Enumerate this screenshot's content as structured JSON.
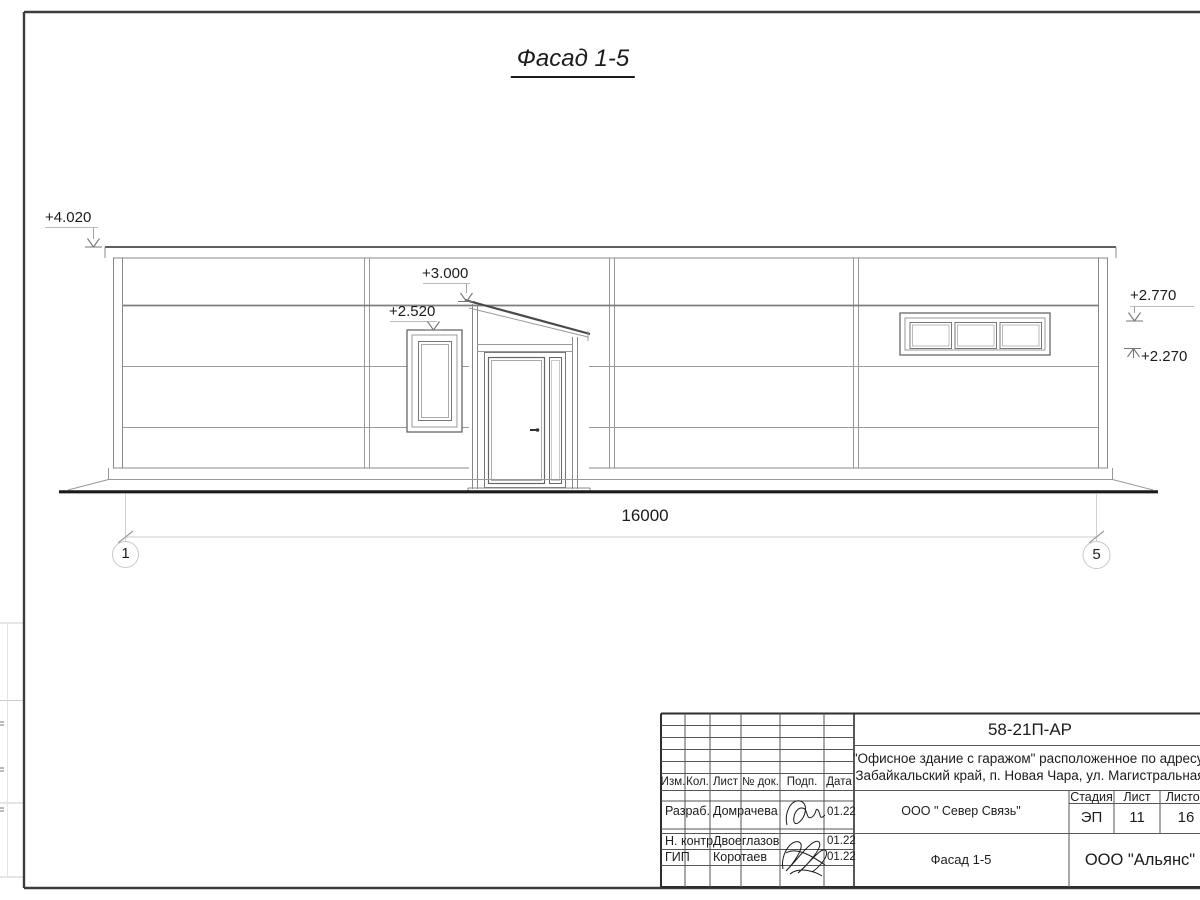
{
  "drawing": {
    "title": "Фасад 1-5"
  },
  "elevations": {
    "roof": "+4.020",
    "canopy": "+3.000",
    "left_window": "+2.520",
    "right_window_top": "+2.770",
    "right_window_bottom": "+2.270"
  },
  "dimension": {
    "overall": "16000"
  },
  "axes": {
    "left": "1",
    "right": "5"
  },
  "title_block": {
    "doc_number": "58-21П-АР",
    "project_address_line1": "\"Офисное здание с гаражом\" расположенное по адресу:",
    "project_address_line2": "Забайкальский край, п. Новая Чара, ул. Магистральная",
    "columns": {
      "izm": "Изм.",
      "kol": "Кол.",
      "list": "Лист",
      "doc": "№ док.",
      "podp": "Подп.",
      "data": "Дата"
    },
    "rows": [
      {
        "role": "Разраб.",
        "name": "Домрачева",
        "date": "01.22"
      },
      {
        "role": "Н. контр.",
        "name": "Двоеглазов",
        "date": "01.22"
      },
      {
        "role": "ГИП",
        "name": "Коротаев",
        "date": "01.22"
      }
    ],
    "client": "ООО \" Север Связь\"",
    "sheet_name": "Фасад 1-5",
    "company": "ООО \"Альянс\"",
    "stage": {
      "label": "Стадия",
      "value": "ЭП"
    },
    "sheet": {
      "label": "Лист",
      "value": "11"
    },
    "sheets": {
      "label": "Листов",
      "value": "16"
    }
  },
  "colors": {
    "frame": "#3c3c3c",
    "line_dark": "#4a4a4a",
    "line_mid": "#808080",
    "line_light": "#aaaaaa",
    "ground": "#1b1b1b"
  }
}
